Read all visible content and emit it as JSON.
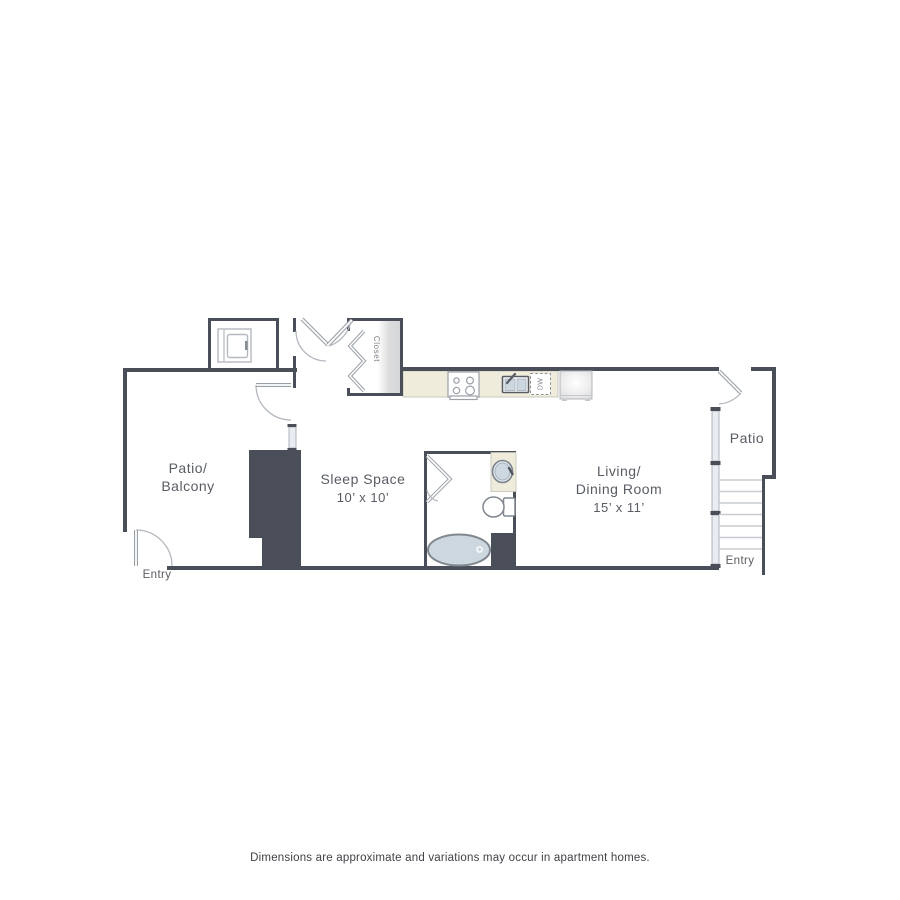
{
  "title": "Apartment floor plan",
  "colors": {
    "wall": "#4a4e58",
    "line": "#9aa0a8",
    "counter": "#f0ecdc",
    "closet_shade": "#d8d9da",
    "window": "#e9edf1",
    "fixture": "#ccd7df",
    "fixture_light": "#e3eaf0",
    "stair": "#c9cdd1",
    "label": "#585c63",
    "muted": "#7d828a",
    "disclaimer": "#3f4246",
    "bg": "#ffffff"
  },
  "rooms": {
    "patio_balcony": {
      "name_line1": "Patio/",
      "name_line2": "Balcony"
    },
    "sleep_space": {
      "name": "Sleep Space",
      "dimensions": "10’ x 10’"
    },
    "living_dining": {
      "name_line1": "Living/",
      "name_line2": "Dining Room",
      "dimensions": "15’ x 11’"
    },
    "patio": {
      "name": "Patio"
    },
    "closet": {
      "name": "Closet"
    }
  },
  "labels": {
    "entry_left": "Entry",
    "entry_right": "Entry",
    "dishwasher": "DW"
  },
  "icons": [
    "washer-dryer-icon",
    "stove-icon",
    "kitchen-sink-icon",
    "dishwasher-icon",
    "refrigerator-icon",
    "vanity-sink-icon",
    "toilet-icon",
    "bathtub-icon",
    "stairs-icon",
    "door-swing-icon",
    "bifold-door-icon",
    "window-icon"
  ],
  "footer": {
    "disclaimer": "Dimensions are approximate and variations may occur in apartment homes."
  }
}
